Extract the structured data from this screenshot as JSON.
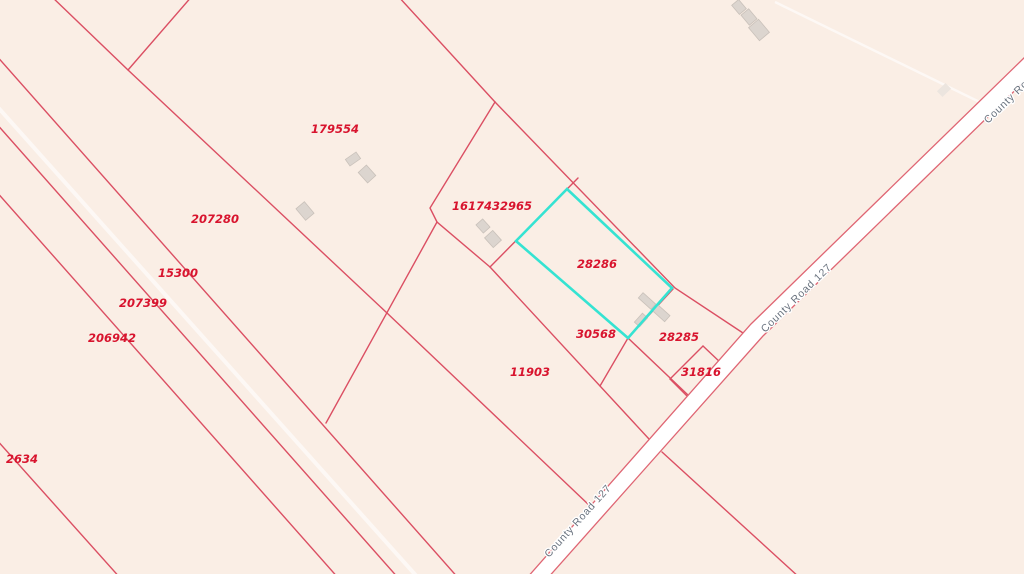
{
  "map": {
    "type": "parcel-map",
    "background_color": "#faeee5",
    "parcel_line_color": "#db4f63",
    "highlight_color": "#35e3d2",
    "parcel_label_color": "#d8142e",
    "road": {
      "name": "County Road 127",
      "fill": "#ffffff",
      "label_color": "#69727e"
    },
    "highlighted_parcel": {
      "id": "28286",
      "points": "567,189 516,241 628,338 672,288"
    },
    "parcel_labels": [
      {
        "id": "179554",
        "x": 335,
        "y": 133
      },
      {
        "id": "207280",
        "x": 215,
        "y": 223
      },
      {
        "id": "15300",
        "x": 178,
        "y": 277
      },
      {
        "id": "207399",
        "x": 143,
        "y": 307
      },
      {
        "id": "206942",
        "x": 112,
        "y": 342
      },
      {
        "id": "2634",
        "x": 22,
        "y": 463
      },
      {
        "id": "1617432965",
        "x": 492,
        "y": 210
      },
      {
        "id": "28286",
        "x": 597,
        "y": 268
      },
      {
        "id": "30568",
        "x": 596,
        "y": 338
      },
      {
        "id": "28285",
        "x": 679,
        "y": 341
      },
      {
        "id": "31816",
        "x": 701,
        "y": 376
      },
      {
        "id": "11903",
        "x": 530,
        "y": 376
      }
    ],
    "road_labels": [
      {
        "text": "County Road 127",
        "x": 988,
        "y": 124,
        "rotation": -44
      },
      {
        "text": "County Road 127",
        "x": 765,
        "y": 333,
        "rotation": -44
      },
      {
        "text": "County Road 127",
        "x": 549,
        "y": 558,
        "rotation": -48
      }
    ]
  }
}
